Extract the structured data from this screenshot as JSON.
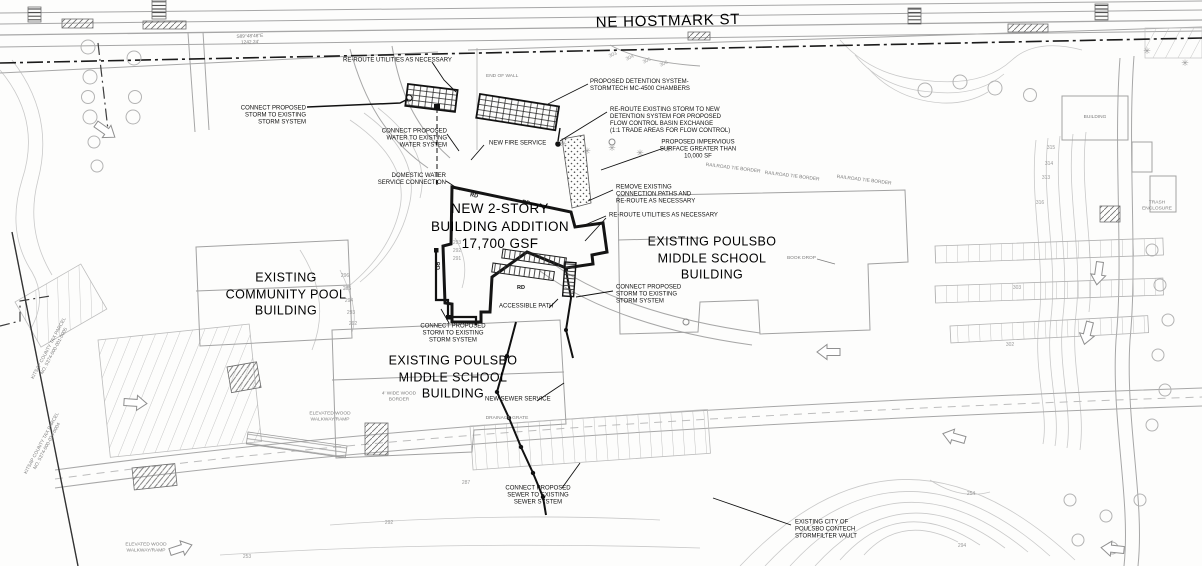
{
  "street": {
    "name": "NE HOSTMARK ST",
    "bearing": "S89°48'48\"E\n1242.24'"
  },
  "buildings": {
    "pool": "EXISTING\nCOMMUNITY POOL\nBUILDING",
    "addition": "NEW 2-STORY\nBUILDING ADDITION\n17,700 GSF",
    "school_right": "EXISTING POULSBO\nMIDDLE SCHOOL\nBUILDING",
    "school_bottom": "EXISTING POULSBO\nMIDDLE SCHOOL\nBUILDING"
  },
  "callouts": {
    "connect_storm_nw": "CONNECT PROPOSED\nSTORM TO EXISTING\nSTORM SYSTEM",
    "reroute_utilities_top": "RE-ROUTE UTILITIES AS NECESSARY",
    "detention": "PROPOSED DETENTION SYSTEM-\nSTORMTECH MC-4500 CHAMBERS",
    "connect_water": "CONNECT PROPOSED\nWATER TO EXISTING\nWATER SYSTEM",
    "fire": "NEW FIRE SERVICE",
    "reroute_storm": "RE-ROUTE EXISTING STORM TO NEW\nDETENTION SYSTEM FOR PROPOSED\nFLOW CONTROL BASIN EXCHANGE\n(1:1 TRADE AREAS FOR FLOW CONTROL)",
    "impervious": "PROPOSED IMPERVIOUS\nSURFACE GREATER THAN\n10,000 SF",
    "remove_paths": "REMOVE EXISTING\nCONNECTION PATHS AND\nRE-ROUTE AS NECESSARY",
    "reroute_utilities_mid": "RE-ROUTE UTILITIES AS NECESSARY",
    "domestic_water": "DOMESTIC WATER\nSERVICE CONNECTION",
    "connect_storm_mid": "CONNECT PROPOSED\nSTORM TO EXISTING\nSTORM SYSTEM",
    "accessible_path": "ACCESSIBLE PATH",
    "connect_storm_pool": "CONNECT PROPOSED\nSTORM TO EXISTING\nSTORM SYSTEM",
    "sewer_service": "NEW SEWER SERVICE",
    "connect_sewer": "CONNECT PROPOSED\nSEWER TO EXISTING\nSEWER SYSTEM",
    "stormfilter": "EXISTING CITY OF\nPOULSBO CONTECH\nSTORMFILTER VAULT"
  },
  "site_notes": {
    "rd": "RD",
    "end_of_wall": "END OF WALL",
    "railroad_tie": "RAILROAD TIE BORDER",
    "book_drop": "BOOK DROP",
    "building": "BUILDING",
    "trash": "TRASH ENCLOSURE",
    "elevated_wood": "ELEVATED WOOD\nWALKWAY/RAMP",
    "wood_border": "4' WIDE WOOD\nBORDER",
    "drainage_grate": "DRAINAGE GRATE",
    "parcel1": "KITSAP COUNTY TAX PARCEL\nNO. 5374-000-001-0005",
    "parcel2": "KITSAP COUNTY TAX PARCEL\nNO. 5374-000-024-0004"
  },
  "contours": [
    "293",
    "292",
    "291",
    "296",
    "295",
    "294",
    "293",
    "292",
    "287",
    "292",
    "253",
    "254",
    "294",
    "315",
    "314",
    "313",
    "316",
    "303",
    "304",
    "305",
    "306",
    "303",
    "302"
  ],
  "colors": {
    "line_bold": "#141414",
    "line_light": "#c3c3c3",
    "line_mid": "#989898",
    "label": "#111111",
    "label_faint": "#7d7d7d"
  }
}
